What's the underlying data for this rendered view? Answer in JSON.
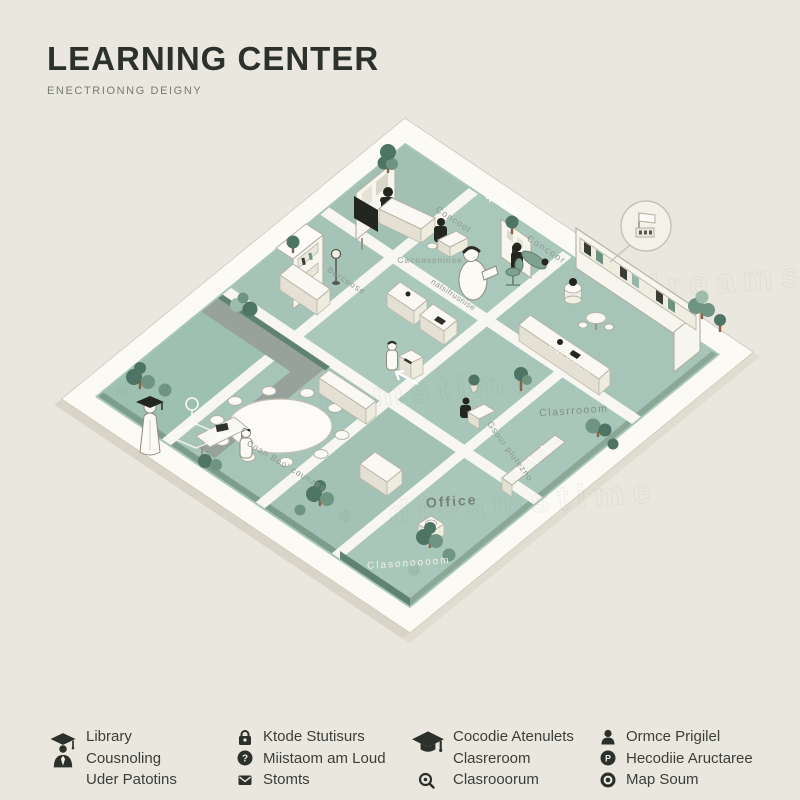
{
  "page": {
    "background": "#e9e7de",
    "accent_green": "#a9c6bb",
    "dark": "#2c312b"
  },
  "header": {
    "title": "LEARNING CENTER",
    "subtitle": "ENECTRIONNG DEIGNY"
  },
  "map": {
    "watermark": "dreamstime",
    "labels": [
      {
        "text": "Concoot",
        "x": 452,
        "y": 222,
        "rot": 33,
        "color": "#8d988f",
        "size": 9,
        "ls": 1
      },
      {
        "text": "Four",
        "x": 505,
        "y": 210,
        "rot": 33,
        "color": "#ffffff",
        "size": 11,
        "ls": 2,
        "bold": true
      },
      {
        "text": "Concoor",
        "x": 545,
        "y": 252,
        "rot": 33,
        "color": "#8d988f",
        "size": 9,
        "ls": 1.5
      },
      {
        "text": "Cacoassninse",
        "x": 430,
        "y": 263,
        "rot": 0,
        "color": "#939b93",
        "size": 8.5,
        "ls": 1
      },
      {
        "text": "Bercoose",
        "x": 345,
        "y": 283,
        "rot": 33,
        "color": "#8d988f",
        "size": 8.5,
        "ls": 1
      },
      {
        "text": "natsifrusnise",
        "x": 452,
        "y": 297,
        "rot": 33,
        "color": "#8d988f",
        "size": 8,
        "ls": 0.5
      },
      {
        "text": "Bar buene",
        "x": 570,
        "y": 361,
        "rot": 33,
        "color": "#f6f5ef",
        "size": 9,
        "ls": 1
      },
      {
        "text": "Clasrrooom",
        "x": 574,
        "y": 414,
        "rot": -4,
        "color": "#7e9187",
        "size": 10.5,
        "ls": 1.5
      },
      {
        "text": "Coan Boo' counzes",
        "x": 285,
        "y": 468,
        "rot": 31,
        "color": "#8d988f",
        "size": 8.5,
        "ls": 1
      },
      {
        "text": "Gsour plutezno",
        "x": 508,
        "y": 453,
        "rot": 54,
        "color": "#8d988f",
        "size": 8.5,
        "ls": 1
      },
      {
        "text": "Office",
        "x": 452,
        "y": 506,
        "rot": -4,
        "color": "#76837a",
        "size": 14,
        "ls": 2,
        "bold": true
      },
      {
        "text": "Clasonoooom",
        "x": 409,
        "y": 566,
        "rot": -4,
        "color": "#f2f1ea",
        "size": 10,
        "ls": 2
      }
    ]
  },
  "legend": {
    "groups": [
      {
        "id": "library",
        "lines": [
          "Library",
          "Cousnoling",
          "Uder Patotins"
        ]
      },
      {
        "id": "services",
        "lines": [
          "Ktode Stutisurs",
          "Miistaom am Loud",
          "Stomts"
        ]
      },
      {
        "id": "classroom",
        "lines": [
          "Cocodie Atenulets",
          "Clasreroom",
          "Clasrooorum"
        ]
      },
      {
        "id": "office",
        "lines": [
          "Ormce Prigilel",
          "Hecodiie Aructaree",
          "Map Soum"
        ]
      }
    ]
  }
}
